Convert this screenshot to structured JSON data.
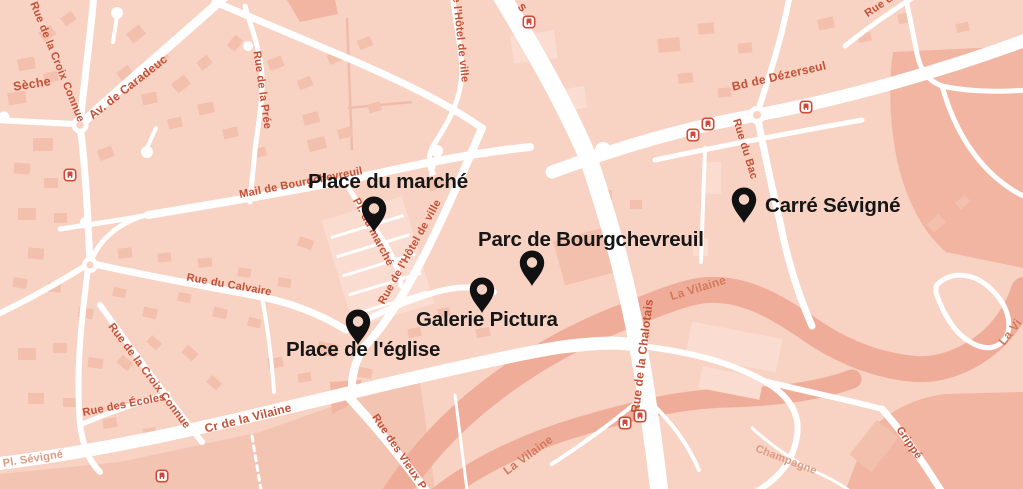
{
  "map": {
    "place": "Cesson-Sévigné area map",
    "colors": {
      "background": "#f8d2c3",
      "building": "#f3c0ae",
      "building_light": "#fadcd0",
      "water": "#efad99",
      "zone_dark": "#f1b5a1",
      "road": "#ffffff",
      "street_label": "#c35138",
      "river_label": "#d4795c",
      "muted_label": "#db9b82",
      "poi_label": "#161616",
      "pin": "#111111",
      "transit_red": "#cf4a3a"
    },
    "pois": [
      {
        "label": "Place du marché",
        "pin": {
          "x": 374,
          "y": 233
        },
        "text": {
          "x": 308,
          "y": 170
        }
      },
      {
        "label": "Parc de Bourgchevreuil",
        "pin": {
          "x": 532,
          "y": 287
        },
        "text": {
          "x": 478,
          "y": 228
        }
      },
      {
        "label": "Carré Sévigné",
        "pin": {
          "x": 744,
          "y": 224
        },
        "text": {
          "x": 765,
          "y": 194
        }
      },
      {
        "label": "Galerie Pictura",
        "pin": {
          "x": 482,
          "y": 314
        },
        "text": {
          "x": 416,
          "y": 308
        }
      },
      {
        "label": "Place de l'église",
        "pin": {
          "x": 358,
          "y": 346
        },
        "text": {
          "x": 286,
          "y": 338
        }
      }
    ],
    "street_labels": [
      {
        "text": "Sèche",
        "x": 32,
        "y": 84,
        "rot": -9,
        "size": 12.5,
        "kind": "street"
      },
      {
        "text": "Rue de la Croix Connue",
        "x": 57,
        "y": 62,
        "rot": 68,
        "kind": "street"
      },
      {
        "text": "Av. de Caradeuc",
        "x": 128,
        "y": 87,
        "rot": -38,
        "size": 12,
        "kind": "street"
      },
      {
        "text": "Rue de la Prée",
        "x": 262,
        "y": 90,
        "rot": 82,
        "kind": "street"
      },
      {
        "text": "Mail de Bourgchevreuil",
        "x": 301,
        "y": 183,
        "rot": -11,
        "kind": "street"
      },
      {
        "text": "Pl. du marché",
        "x": 373,
        "y": 232,
        "rot": 62,
        "kind": "street"
      },
      {
        "text": "Rue de l'Hôtel de ville",
        "x": 410,
        "y": 252,
        "rot": -61,
        "kind": "street"
      },
      {
        "text": "de l'Hôtel de ville",
        "x": 460,
        "y": 36,
        "rot": 84,
        "kind": "street"
      },
      {
        "text": "s",
        "x": 523,
        "y": 7,
        "rot": 50,
        "size": 13,
        "kind": "street"
      },
      {
        "text": "Bd de Dézerseul",
        "x": 779,
        "y": 76,
        "rot": -13,
        "size": 12,
        "kind": "street"
      },
      {
        "text": "Rue d",
        "x": 879,
        "y": 6,
        "rot": -34,
        "kind": "street"
      },
      {
        "text": "Rue du Bac",
        "x": 745,
        "y": 149,
        "rot": 73,
        "kind": "street"
      },
      {
        "text": "Rue du Calvaire",
        "x": 229,
        "y": 285,
        "rot": 10,
        "kind": "street"
      },
      {
        "text": "Rue de la Croix Connue",
        "x": 149,
        "y": 376,
        "rot": 53,
        "kind": "street"
      },
      {
        "text": "Rue des Écoles",
        "x": 124,
        "y": 405,
        "rot": -11,
        "kind": "street"
      },
      {
        "text": "Pl. Sévigné",
        "x": 33,
        "y": 459,
        "rot": -9,
        "kind": "muted"
      },
      {
        "text": "Cr de la Vilaine",
        "x": 248,
        "y": 418,
        "rot": -14,
        "size": 12,
        "kind": "street"
      },
      {
        "text": "Rue des Vieux P",
        "x": 399,
        "y": 452,
        "rot": 56,
        "kind": "street"
      },
      {
        "text": "Rue de la Chalotais",
        "x": 642,
        "y": 356,
        "rot": -83,
        "size": 12,
        "kind": "street"
      },
      {
        "text": "Champagne",
        "x": 786,
        "y": 460,
        "rot": 21,
        "kind": "muted"
      },
      {
        "text": "Grippé",
        "x": 909,
        "y": 443,
        "rot": 55,
        "kind": "street"
      },
      {
        "text": "La Vilaine",
        "x": 698,
        "y": 288,
        "rot": -17,
        "size": 12,
        "kind": "river"
      },
      {
        "text": "La Vilaine",
        "x": 528,
        "y": 455,
        "rot": -36,
        "size": 12,
        "kind": "river"
      },
      {
        "text": "La Vi",
        "x": 1010,
        "y": 332,
        "rot": -52,
        "size": 12,
        "kind": "river"
      }
    ],
    "transit_stops": [
      {
        "x": 70,
        "y": 175
      },
      {
        "x": 162,
        "y": 476
      },
      {
        "x": 529,
        "y": 22
      },
      {
        "x": 693,
        "y": 135
      },
      {
        "x": 708,
        "y": 124
      },
      {
        "x": 806,
        "y": 107
      },
      {
        "x": 625,
        "y": 423
      },
      {
        "x": 640,
        "y": 416
      }
    ]
  }
}
